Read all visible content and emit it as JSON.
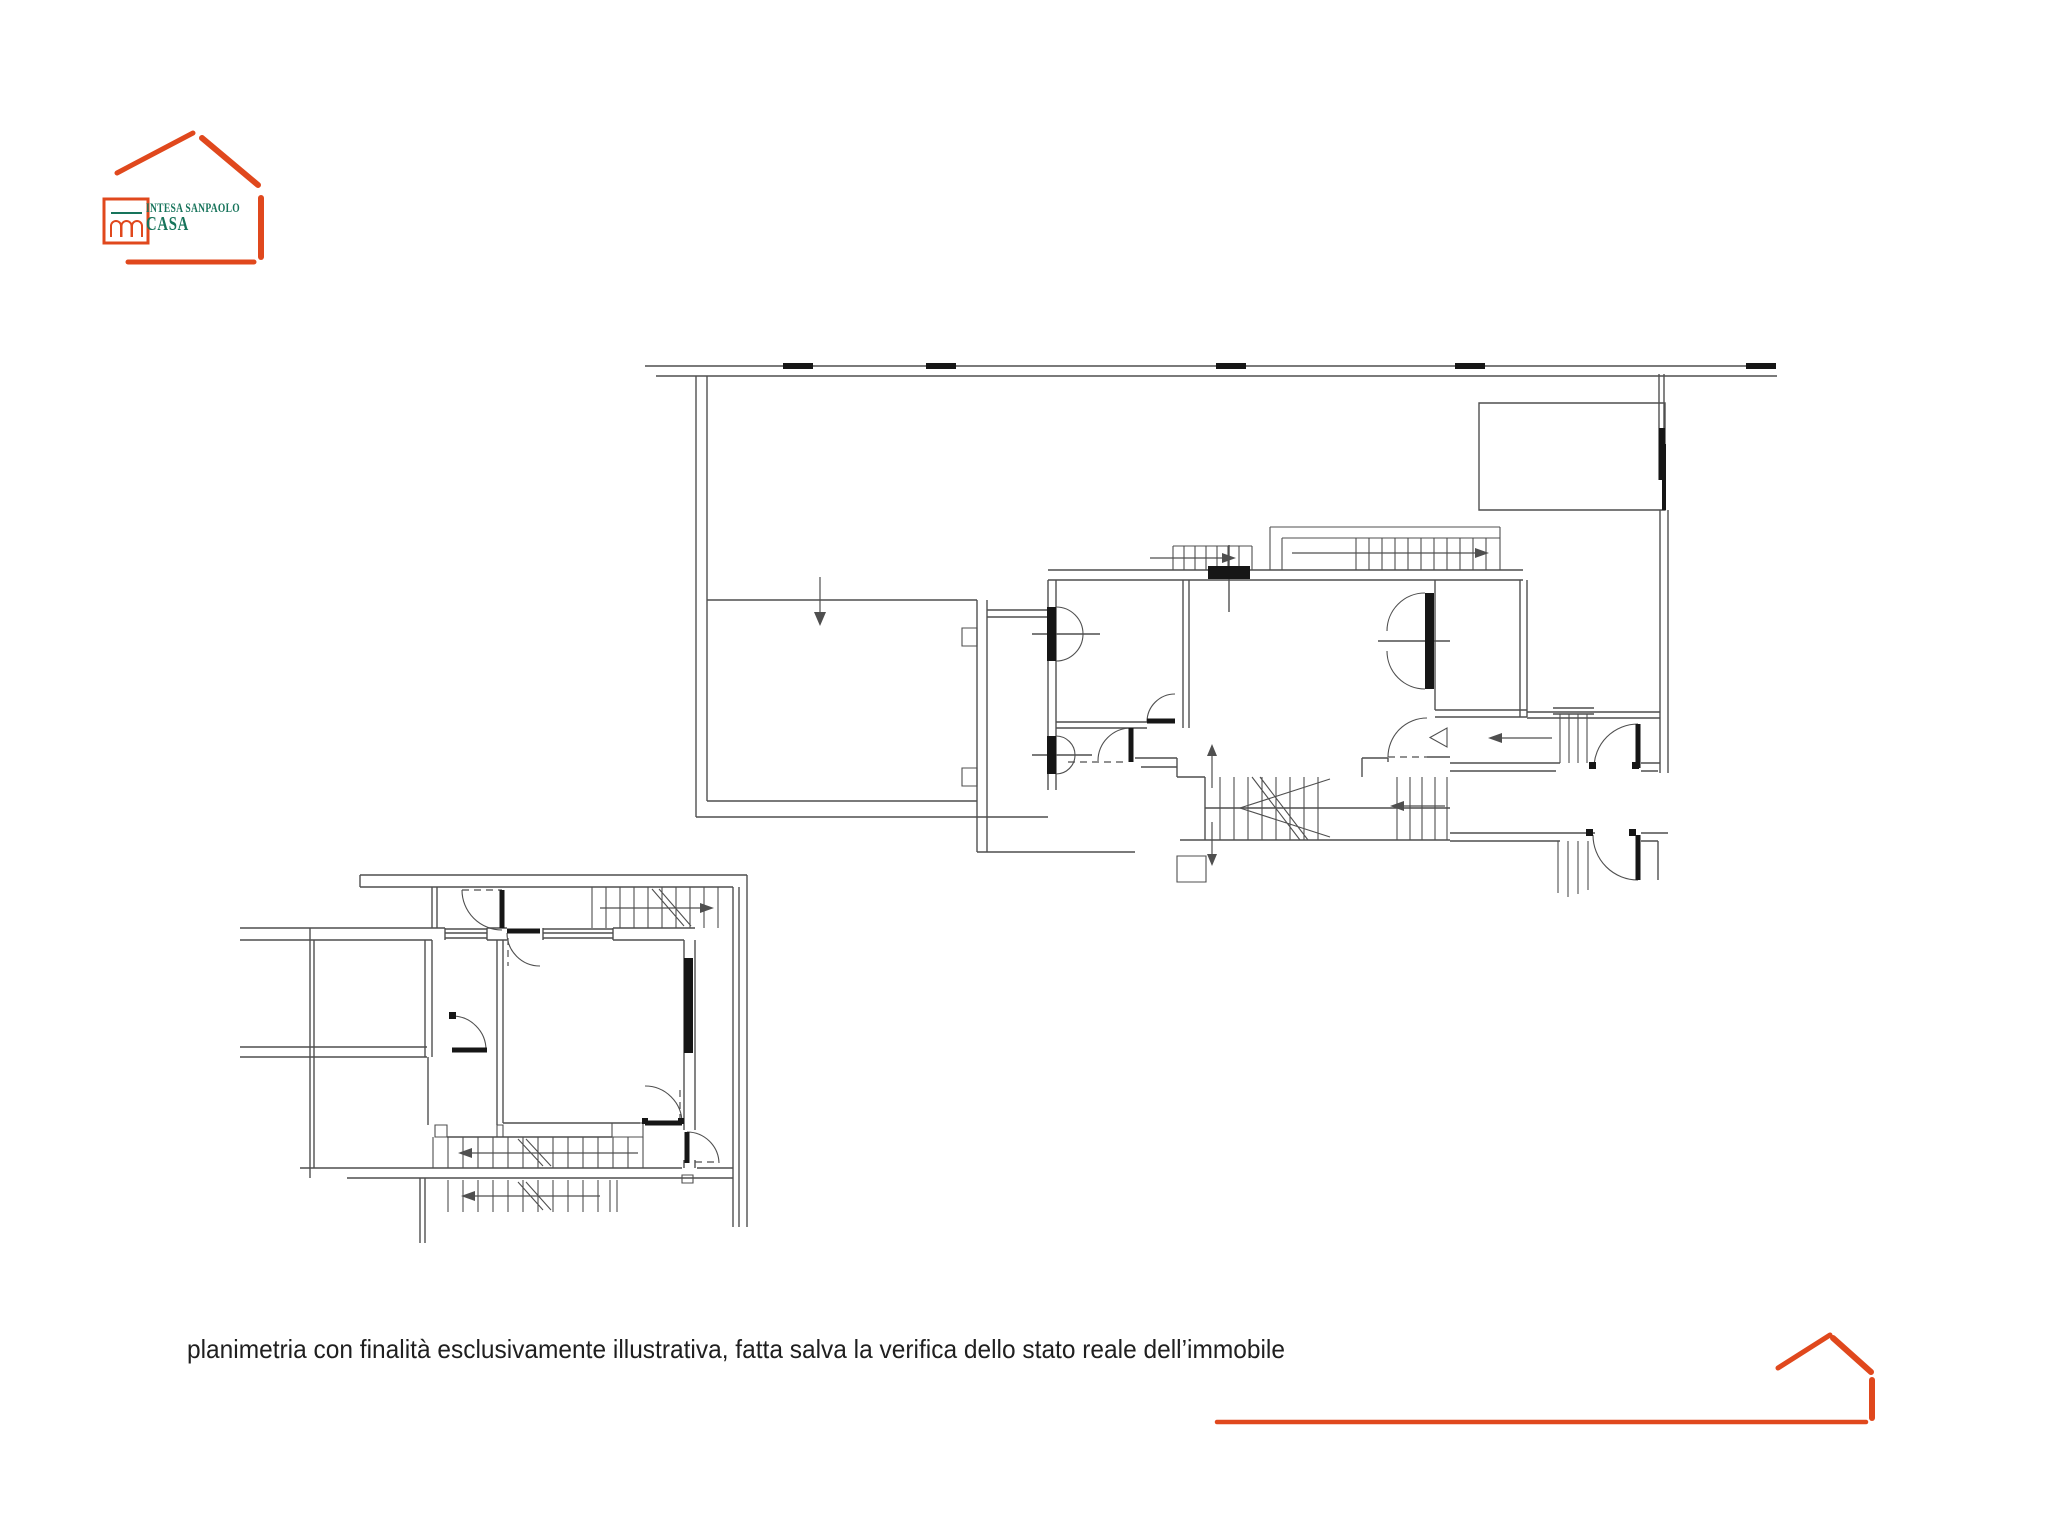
{
  "colors": {
    "background": "#ffffff",
    "orange": "#E0481D",
    "green": "#17745B",
    "wall": "#4f4f4f",
    "dark": "#161616",
    "text": "#1f1f1f"
  },
  "header_logo": {
    "icon": "house-sketch-icon",
    "square_icon": "arches-icon",
    "brand": "INTESA SANPAOLO",
    "product": "CASA"
  },
  "footer": {
    "disclaimer": "planimetria con finalità esclusivamente illustrativa, fatta salva la verifica dello stato reale dell’immobile",
    "logo_icon": "house-sketch-icon"
  }
}
